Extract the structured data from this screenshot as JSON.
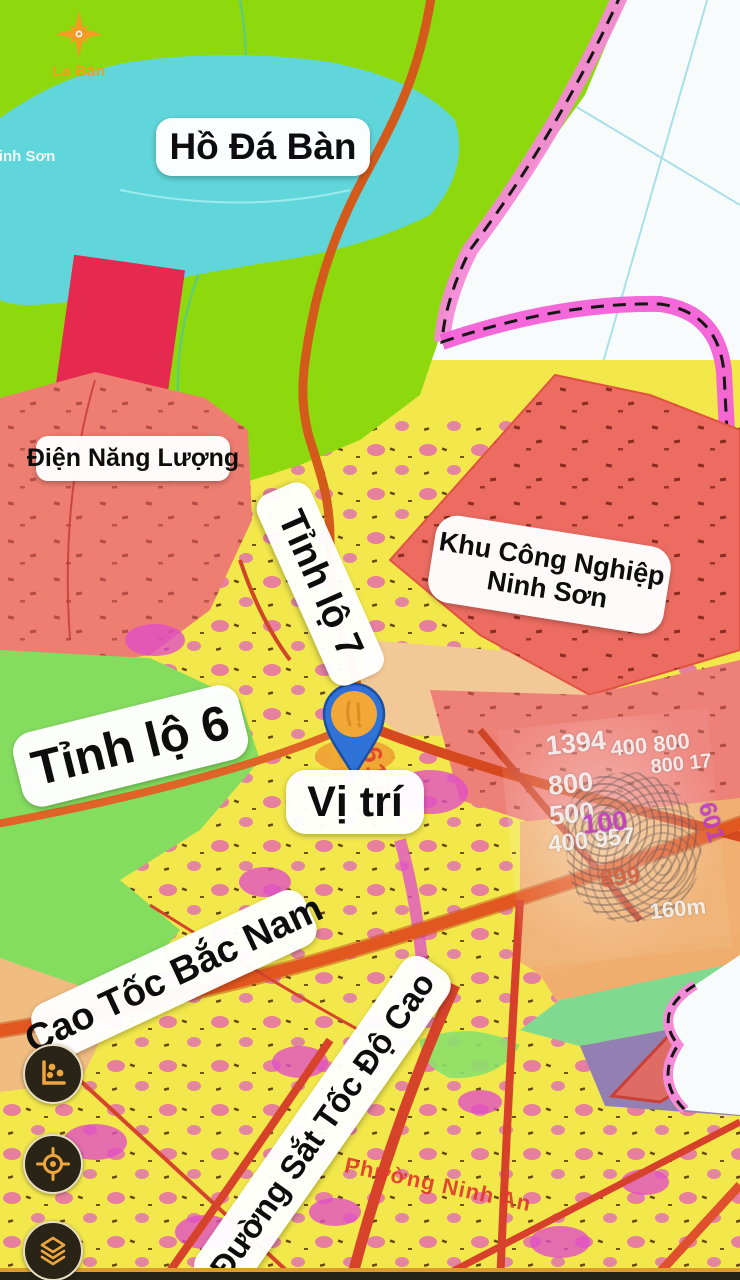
{
  "app": {
    "name": "La Bàn",
    "logo_color": "#f59a23"
  },
  "map_labels": {
    "lake": "Hồ Đá Bàn",
    "energy": "Điện Năng Lượng",
    "road7": "Tỉnh lộ 7",
    "industrial_line1": "Khu Công Nghiệp",
    "industrial_line2": "Ninh Sơn",
    "road6": "Tỉnh lộ 6",
    "location": "Vị trí",
    "expressway": "Cao Tốc Bắc Nam",
    "railway": "Đường Sắt Tốc Độ Cao"
  },
  "map_texts": {
    "parcel_number": "6179",
    "ward": "Phường Ninh An",
    "district": "Ninh Sơn"
  },
  "watermark": {
    "n0": "1394",
    "n1": "400 800",
    "n2": "800 17",
    "n3": "800",
    "n4": "500",
    "n5": "400 957",
    "n6": "100",
    "n7": "899",
    "n8": "160m",
    "n9": "601"
  },
  "controls": {
    "buttons": [
      {
        "icon": "chart-scatter"
      },
      {
        "icon": "gps-locate"
      },
      {
        "icon": "layers"
      }
    ]
  },
  "colors": {
    "land_green": "#8ed90e",
    "water_cyan": "#60d6da",
    "zone_salmon": "#ec6c61",
    "zone_crimson": "#e6294f",
    "zone_yellow": "#f2e84b",
    "zone_magenta": "#e14fc6",
    "zone_purple": "#9280b2",
    "zone_tan": "#f3c897",
    "road_orange": "#d85a1e",
    "road_red": "#d6432a",
    "boundary_pink": "#f58ad8",
    "pin_blue": "#2f72d8",
    "pin_orange": "#f3a736",
    "button_bg": "#2a2416",
    "button_icon": "#eda63e"
  }
}
